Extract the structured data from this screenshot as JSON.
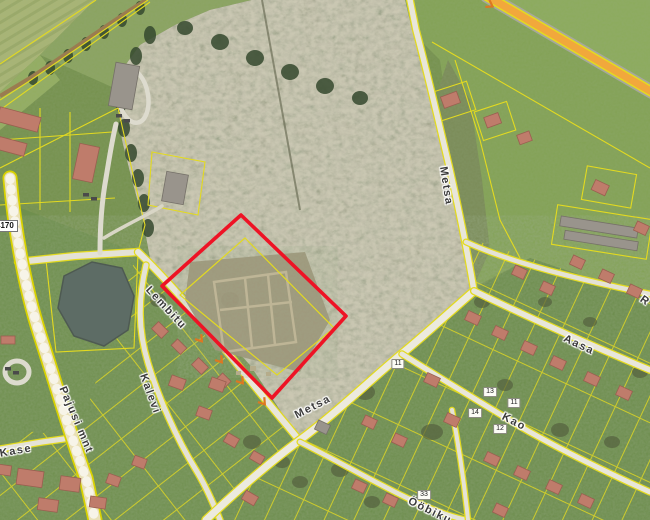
{
  "map": {
    "highlight_color": "#ee1325",
    "parcel_line_color": "#e6dd14",
    "main_road_color": "#e9e0b6",
    "orange_road_color": "#f1a83c",
    "road_number_badge": "4170",
    "street_labels": [
      {
        "text": "Lembitu",
        "x": 166,
        "y": 308,
        "rot": 47
      },
      {
        "text": "Kalevi",
        "x": 150,
        "y": 394,
        "rot": 70
      },
      {
        "text": "Pajusi mnt",
        "x": 76,
        "y": 420,
        "rot": 67
      },
      {
        "text": "Kase",
        "x": 16,
        "y": 451,
        "rot": -10
      },
      {
        "text": "Metsa",
        "x": 313,
        "y": 407,
        "rot": -27
      },
      {
        "text": "Metsa",
        "x": 446,
        "y": 186,
        "rot": 81
      },
      {
        "text": "Aasa",
        "x": 579,
        "y": 345,
        "rot": 25
      },
      {
        "text": "Kao",
        "x": 514,
        "y": 422,
        "rot": 27
      },
      {
        "text": "Ööbiku",
        "x": 430,
        "y": 511,
        "rot": 26
      },
      {
        "text": "R",
        "x": 645,
        "y": 301,
        "rot": 35
      }
    ],
    "house_numbers": [
      {
        "text": "13",
        "x": 490,
        "y": 392
      },
      {
        "text": "11",
        "x": 514,
        "y": 403
      },
      {
        "text": "14",
        "x": 475,
        "y": 413
      },
      {
        "text": "12",
        "x": 500,
        "y": 429
      },
      {
        "text": "33",
        "x": 424,
        "y": 495
      },
      {
        "text": "11",
        "x": 398,
        "y": 364
      }
    ]
  }
}
